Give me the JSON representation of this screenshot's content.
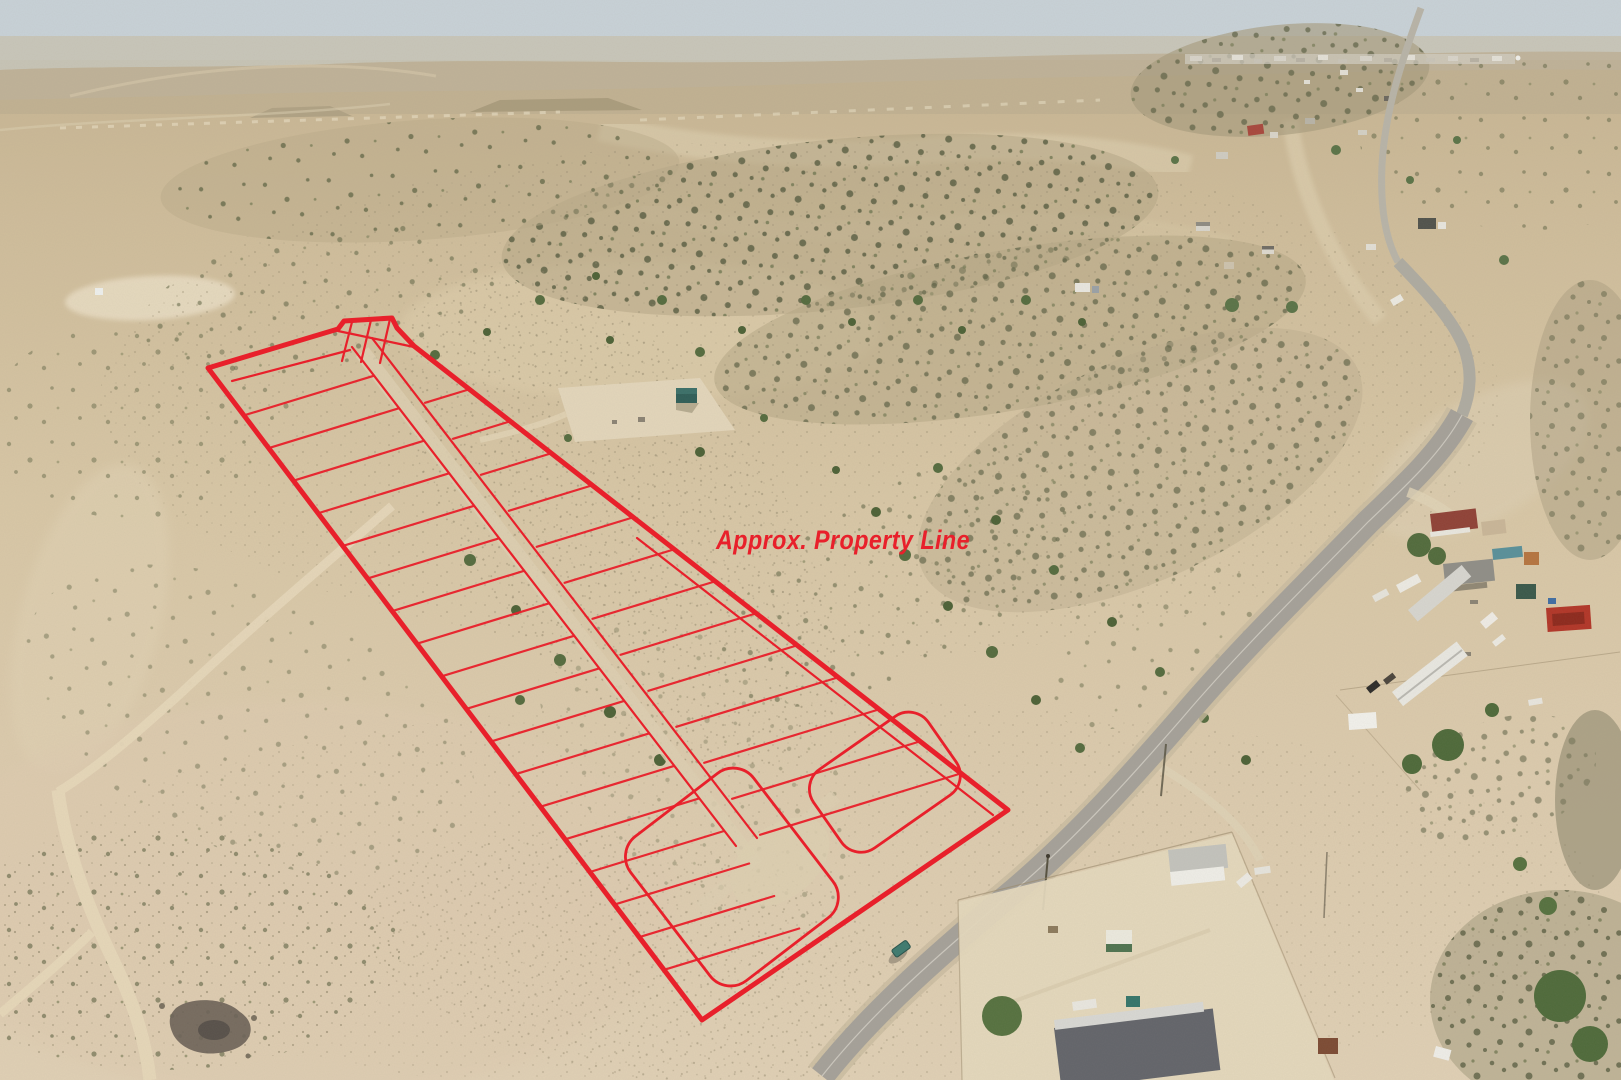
{
  "scene": {
    "type": "aerial drone photograph",
    "subject": "High-desert land parcel with surveyed subdivision lots outlined in red",
    "features": [
      "desert scrubland",
      "distant town on horizon",
      "two-lane rural road",
      "scattered rural homes, trailers and sheds",
      "dirt tracks",
      "cleared pad with small building",
      "car on road"
    ]
  },
  "overlay": {
    "label": "Approx. Property Line",
    "color": "#e8202b",
    "nw_lot_lines": 18,
    "se_lot_lines": 13
  },
  "palette": {
    "sky": "#c8d2d8",
    "sand_light": "#e0d0b5",
    "sand_mid": "#d3c2a0",
    "sand_far": "#c6b492",
    "shrub_olive": "#5c6044",
    "tree_green": "#546b3e",
    "pavement_gray": "#a5a199",
    "dirt_track": "#e6d7b9"
  }
}
